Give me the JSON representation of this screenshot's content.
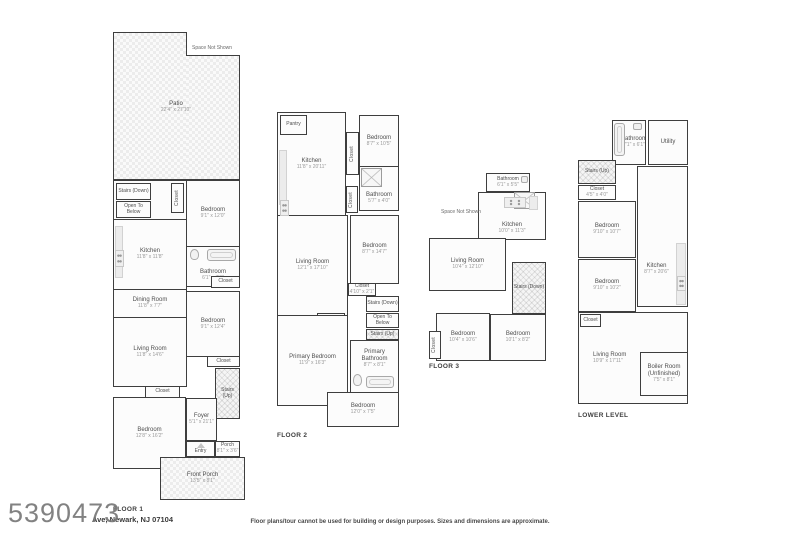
{
  "meta": {
    "watermark": "5390473",
    "address": "Ave, Newark, NJ 07104",
    "disclaimer": "Floor plans/tour cannot be used for building or design purposes. Sizes and dimensions are approximate."
  },
  "floor1": {
    "label": "FLOOR 1",
    "space_not_shown": "Space Not Shown",
    "patio": {
      "name": "Patio",
      "dims": "22'4\" x 27'10\""
    },
    "stairs_down": "Stairs (Down)",
    "open_to_below": "Open To Below",
    "closet_top": "Closet",
    "bedroom_top": {
      "name": "Bedroom",
      "dims": "9'1\" x 12'0\""
    },
    "kitchen": {
      "name": "Kitchen",
      "dims": "11'8\" x 11'8\""
    },
    "bathroom": {
      "name": "Bathroom",
      "dims": "6'1\" x 7'9\""
    },
    "closet_bath": "Closet",
    "dining": {
      "name": "Dining Room",
      "dims": "11'8\" x 7'7\""
    },
    "bedroom_mid": {
      "name": "Bedroom",
      "dims": "9'1\" x 12'4\""
    },
    "living": {
      "name": "Living Room",
      "dims": "11'8\" x 14'6\""
    },
    "closet_mid": "Closet",
    "stairs_up": "Stairs (Up)",
    "closet_bed": "Closet",
    "bedroom_front": {
      "name": "Bedroom",
      "dims": "12'8\" x 16'2\""
    },
    "foyer": {
      "name": "Foyer",
      "dims": "5'1\" x 21'1\""
    },
    "entry": "Entry",
    "porch": {
      "name": "Porch",
      "dims": "8'1\" x 3'6\""
    },
    "front_porch": {
      "name": "Front Porch",
      "dims": "13'5\" x 8'1\""
    }
  },
  "floor2": {
    "label": "FLOOR 2",
    "pantry": "Pantry",
    "kitchen": {
      "name": "Kitchen",
      "dims": "11'8\" x 20'11\""
    },
    "closet_kitchen": "Closet",
    "bedroom_top": {
      "name": "Bedroom",
      "dims": "8'7\" x 10'5\""
    },
    "bathroom": {
      "name": "Bathroom",
      "dims": "5'7\" x 4'0\""
    },
    "closet_bath": "Closet",
    "living": {
      "name": "Living Room",
      "dims": "12'1\" x 17'10\""
    },
    "bedroom_mid": {
      "name": "Bedroom",
      "dims": "8'7\" x 14'7\""
    },
    "closet_mid": {
      "name": "Closet",
      "dims": "4'10\" x 2'1\""
    },
    "stairs_down": "Stairs (Down)",
    "open_to_below": "Open To Below",
    "stairs_up": "Stairs (Up)",
    "closet_primary": "Closet",
    "primary_bedroom": {
      "name": "Primary Bedroom",
      "dims": "11'9\" x 16'3\""
    },
    "primary_bathroom": {
      "name": "Primary Bathroom",
      "dims": "8'7\" x 8'1\""
    },
    "bedroom_bottom": {
      "name": "Bedroom",
      "dims": "12'0\" x 7'5\""
    }
  },
  "floor3": {
    "label": "FLOOR 3",
    "space_not_shown": "Space Not Shown",
    "bathroom": {
      "name": "Bathroom",
      "dims": "6'1\" x 5'5\""
    },
    "kitchen": {
      "name": "Kitchen",
      "dims": "10'0\" x 11'3\""
    },
    "living": {
      "name": "Living Room",
      "dims": "10'4\" x 12'10\""
    },
    "stairs_down": "Stairs (Down)",
    "bedroom_left": {
      "name": "Bedroom",
      "dims": "10'4\" x 10'6\""
    },
    "bedroom_right": {
      "name": "Bedroom",
      "dims": "10'1\" x 8'2\""
    },
    "closet": "Closet"
  },
  "lower": {
    "label": "LOWER LEVEL",
    "bathroom": {
      "name": "Bathroom",
      "dims": "7'1\" x 6'1\""
    },
    "utility": "Utility",
    "stairs_up": "Stairs (Up)",
    "closet_top": {
      "name": "Closet",
      "dims": "4'5\" x 4'0\""
    },
    "bedroom_top": {
      "name": "Bedroom",
      "dims": "9'10\" x 10'7\""
    },
    "bedroom_mid": {
      "name": "Bedroom",
      "dims": "9'10\" x 10'2\""
    },
    "kitchen": {
      "name": "Kitchen",
      "dims": "8'7\" x 20'6\""
    },
    "closet_living": "Closet",
    "living": {
      "name": "Living Room",
      "dims": "10'9\" x 17'11\""
    },
    "boiler": {
      "name": "Boiler Room",
      "sub": "(Unfinished)",
      "dims": "7'5\" x 8'1\""
    }
  }
}
